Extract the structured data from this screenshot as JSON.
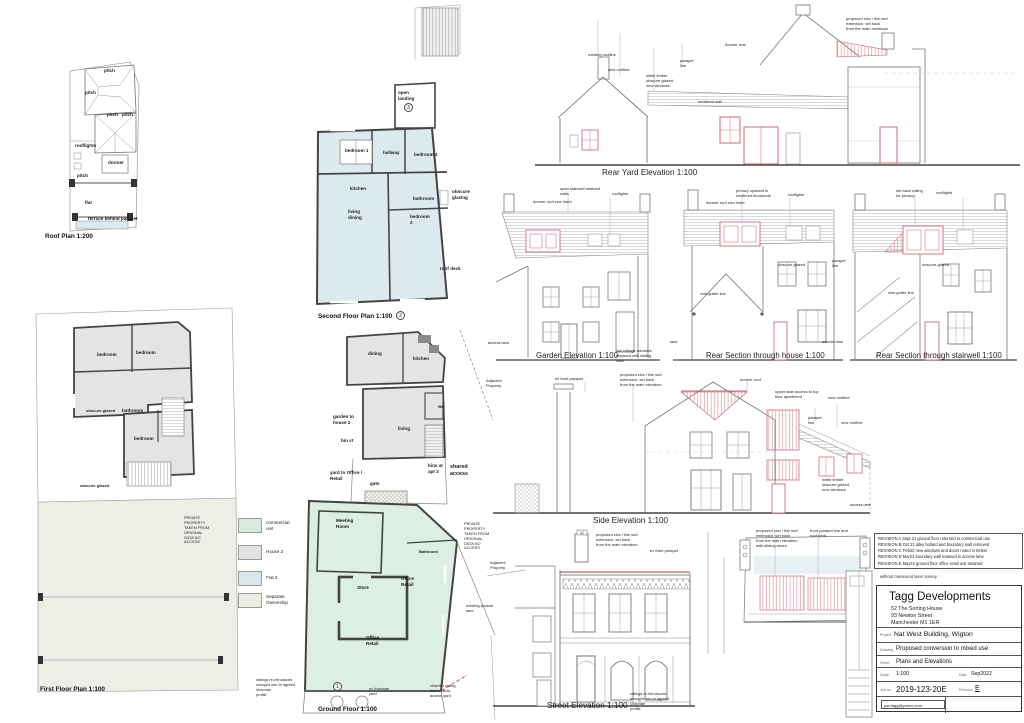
{
  "sheet": {
    "background": "#ffffff",
    "line_color": "#444444",
    "proposed_color": "#c75b6b"
  },
  "roof_plan": {
    "title": "Roof Plan 1:200",
    "labels": {
      "pitch": "pitch",
      "rooflights": "rooflights",
      "dormer": "dormer",
      "flat": "flat",
      "terrace": "terrace behind parapet"
    }
  },
  "second_floor_plan": {
    "title": "Second Floor Plan 1:100",
    "plan_number": "2",
    "landing_number": "3",
    "labels": {
      "open_landing": "open\nlanding",
      "bedroom1": "bedroom 1",
      "hallway": "hallway",
      "bedroom3": "bedroom 3",
      "kitchen": "kitchen",
      "bathroom": "bathroom",
      "obscure_glazing": "obscure\nglazing",
      "living_dining": "living\ndining",
      "bedroom2": "bedroom\n2",
      "roof_deck": "roof deck"
    }
  },
  "house2_first_floor": {
    "labels": {
      "dining": "dining",
      "kitchen": "kitchen",
      "wc": "wc",
      "living": "living",
      "garden": "garden to\nhouse 2",
      "bin_st": "bin st",
      "yard": "yard to Office /\nRetail",
      "gate": "gate",
      "bins": "bins at\napt 3",
      "shared_access": "shared\naccess"
    }
  },
  "ground_floor_plan": {
    "title": "Ground Floor 1:100",
    "plan_number": "1",
    "labels": {
      "meeting_room": "Meeting\nRoom",
      "bathroom": "Bathroom",
      "store": "Store",
      "office_retail": "Office\nRetail",
      "private_property": "PRIVATE\nPROPERTY\nTAKEN FROM\nORIGINAL\nDATA NO\nACCESS",
      "existing_access": "existing access\nlane",
      "railings": "railings re-introduced\nwrought iron to agreed\nVictorian\nprofile",
      "frontage": "ex frontage\nyard",
      "chamfer": "chamfer railing\nline to allow\naccess yard"
    }
  },
  "first_floor_plan": {
    "title": "First Floor Plan 1:100",
    "labels": {
      "bedroom": "bedroom",
      "bathroom": "bathroom",
      "obscure_glazed": "obscure glazed",
      "private_property": "PRIVATE\nPROPERTY\nTAKEN FROM\nORIGINAL\nDATA NO\nACCESS"
    }
  },
  "legend": {
    "items": [
      {
        "label": "commercial\nunit",
        "color": "#d9ebdf"
      },
      {
        "label": "House 2",
        "color": "#e2e2e2"
      },
      {
        "label": "Flat 3",
        "color": "#d9e7ee"
      },
      {
        "label": "Separate\nOwnership",
        "color": "#edece2"
      }
    ]
  },
  "rear_yard_elevation": {
    "title": "Rear Yard Elevation 1:100",
    "labels": {
      "existing_roofline": "existing roofline",
      "new_roofline": "new roofline",
      "white_timber": "white timber\nobscure glazed\nnew windows",
      "parapet_line": "parapet\nline",
      "dormer_rear": "dormer rear",
      "rendered_wall": "rendered wall",
      "proposed_zinc": "proposed zinc / flat roof\nextension, set back\nfrom the main roofslope"
    }
  },
  "garden_elevation": {
    "title": "Garden Elevation 1:100",
    "labels": {
      "open_stairwell": "open stairwell retained\nwalls",
      "rooflights": "rooflights",
      "dormer_roof": "dormer roof zinc lined",
      "access_lane": "access lane",
      "footnote": "low cottage windows\nreplaced with sliding\nsash"
    }
  },
  "rear_section_house": {
    "title": "Rear Section through house 1:100",
    "labels": {
      "privacy_upstand": "privacy upstand in\nrendered blockwork",
      "rooflights": "rooflights",
      "dormer_roof": "dormer roof zinc lined",
      "obscure_glazed": "obscure glazed",
      "rear_gutter": "rear gutter line",
      "parapet_line": "parapet\nline",
      "lane": "lane",
      "access_lane": "access lane"
    }
  },
  "rear_section_stairwell": {
    "title": "Rear Section through stairwell 1:100",
    "labels": {
      "set_back_railing": "set back railing\nfor privacy",
      "rooflights": "rooflights",
      "obscure_glazed": "obscure glazed",
      "rear_gutter": "rear gutter line"
    }
  },
  "side_elevation": {
    "title": "Side Elevation 1:100",
    "labels": {
      "adjacent_property": "Adjacent\nProperty",
      "ex_front_parapet": "ex front parapet",
      "proposed_zinc": "proposed zinc / flat roof\nextension, set back\nfrom the main elevation",
      "dormer_roof": "dormer roof",
      "upper_stair": "upper stair access to top\nfloor apartment",
      "new_roofline": "new roofline",
      "parapet_line": "parapet\nline",
      "white_timber": "white timber\nobscure glazed\nnew windows",
      "access_lane": "access lane"
    }
  },
  "street_elevation": {
    "title": "Street Elevation 1:100",
    "labels": {
      "proposed_zinc": "proposed zinc / flat roof\nextension, set back\nfrom the main elevation",
      "ex_front_parapet": "ex front parapet",
      "adjacent_property": "Adjacent\nProperty",
      "railings": "railings re-introduced\nwrought iron to agreed\nVictorian\nprofile"
    }
  },
  "roof_deck_plan": {
    "labels": {
      "proposed_zinc": "proposed zinc / flat roof\nextension, set back\nfrom the main elevation\nwith sliding doors",
      "front_parapet": "front parapet line and\nroof deck"
    }
  },
  "revisions": {
    "items": [
      "REVISION A  Sept 21  ground floor returned to commercial use",
      "REVISION B  Oct 21  alley bollard and boundary wall removed",
      "REVISION C  Feb22  new windows and doors noted in timber",
      "REVISION D  Mar22  boundary wall retained in access lane",
      "REVISION E  May22  ground floor office retail unit retained"
    ],
    "note": "without measured laser survey"
  },
  "title_block": {
    "company": "Tagg Developments",
    "address": "52 The Sorting House\n93 Newton Street\nManchester M1 1ER",
    "project_label": "Project",
    "project": "Nat West Building, Wigton",
    "drawing_label": "Drawing",
    "drawing": "Proposed conversion to mixed use",
    "sheet_label": "Sheet",
    "sheet": "Plans and Elevations",
    "scale_label": "Scale",
    "scale": "1:100",
    "date_label": "Date",
    "date": "Sep2022",
    "job_label": "Job no",
    "job_number": "2019-123-20E",
    "revision_label": "Revision",
    "revision": "E",
    "email": "pat.tagg@yahoo.com"
  }
}
